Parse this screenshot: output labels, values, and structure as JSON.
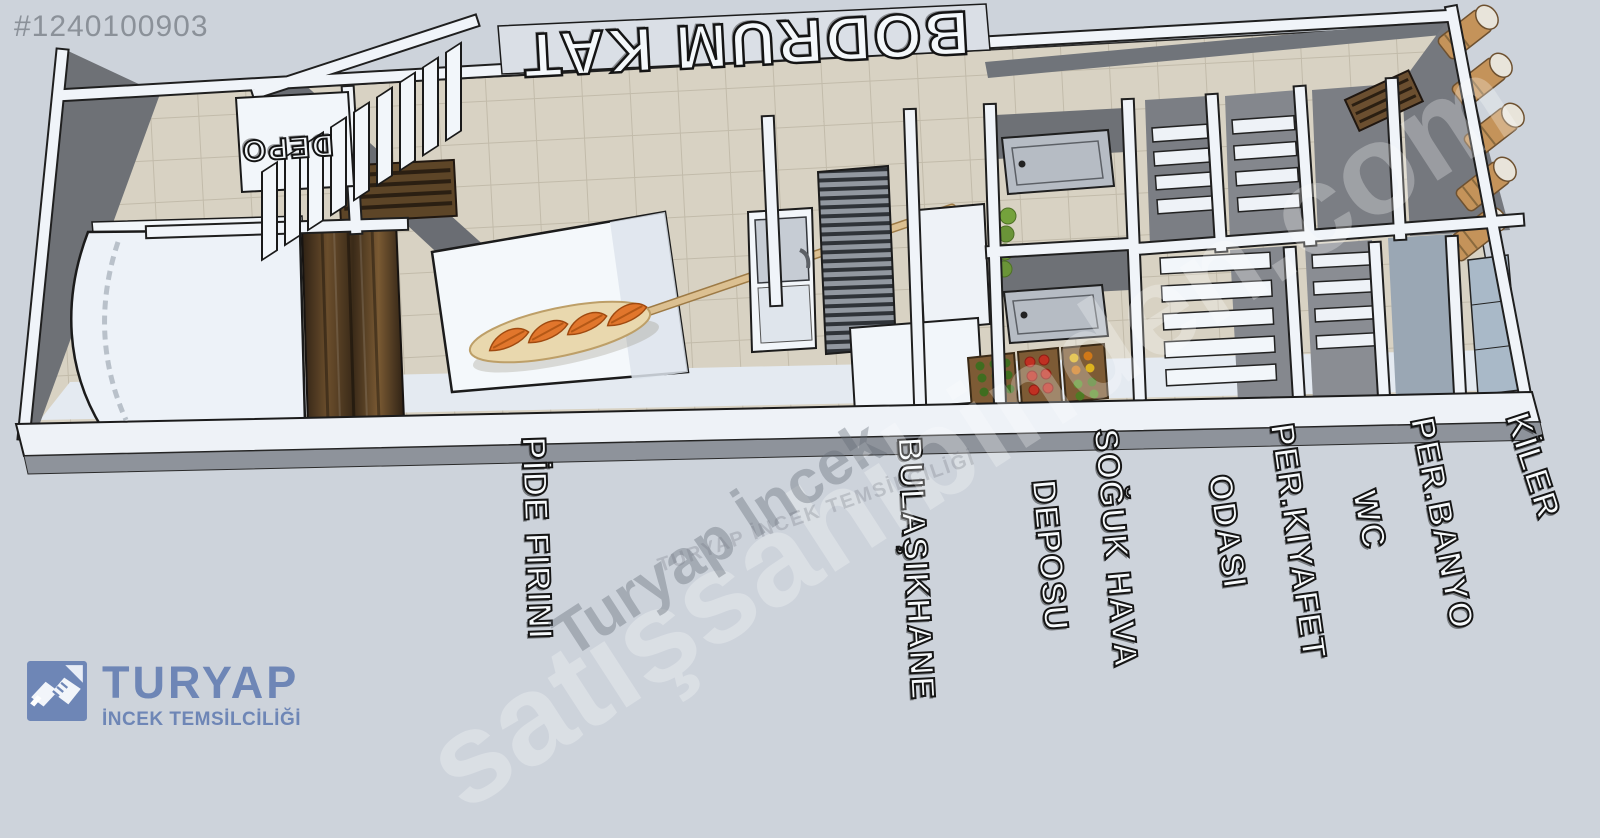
{
  "photo_id": "#1240100903",
  "floor_title": "BODRUM KAT",
  "rooms": {
    "depo": "DEPO",
    "labels": [
      {
        "lines": [
          "PİDE FIRINI"
        ]
      },
      {
        "lines": [
          "BULAŞIKHANE"
        ]
      },
      {
        "lines": [
          "SOĞUK HAVA",
          "DEPOSU"
        ]
      },
      {
        "lines": [
          "PER.KIYAFET",
          "ODASI"
        ]
      },
      {
        "lines": [
          "PER.BANYO",
          "WC"
        ]
      },
      {
        "lines": [
          "KİLER"
        ]
      }
    ]
  },
  "watermarks": {
    "primary": "satışsahibinden.com",
    "secondary": "Turyap İncek",
    "tertiary": "TURYAP İNCEK TEMSİLCİLİĞİ"
  },
  "branding": {
    "agency": "TURYAP",
    "branch": "İNCEK TEMSİLCİLİĞİ",
    "icon": "handshake-icon"
  },
  "colors": {
    "background": "#cdd3db",
    "brand_blue": "#6e86b6",
    "wall_white": "#f0f4f9",
    "wall_gray_face": "#6e7176",
    "tile_floor": "#d8d2c3",
    "wood": "#5a4127",
    "pide_orange": "#e1762c",
    "peel_tan": "#e9d8ae",
    "id_gray": "#8b9199"
  }
}
